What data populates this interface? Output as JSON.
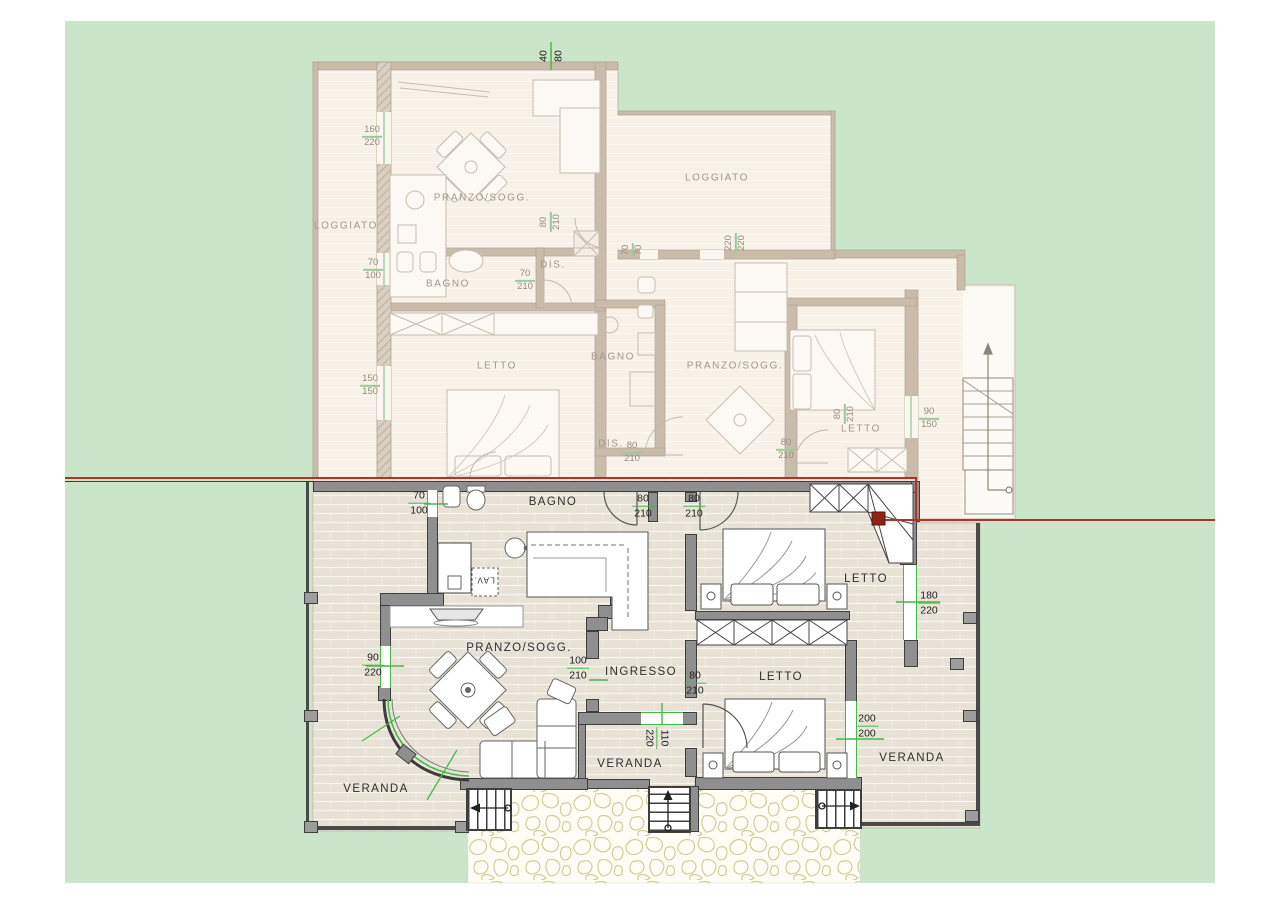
{
  "scene": {
    "background": "#ffffff",
    "lawn_color": "#cbe5ca",
    "section_line_color": "#b23228",
    "dimension_color": "#45b945",
    "lower_floor_color": "#e8e1d5",
    "upper_floor_color": "#f7f1e8",
    "wall_color": "#8f8f8f",
    "wall_outline": "#3e3e3e",
    "stone_edge_color": "#d0ca8e",
    "text_color": "#2e2e2e",
    "faded_text_color": "#a2988b"
  },
  "lower_plan": {
    "rooms": [
      {
        "t": "BAGNO",
        "x": 553,
        "y": 502
      },
      {
        "t": "PRANZO/SOGG.",
        "x": 519,
        "y": 648
      },
      {
        "t": "INGRESSO",
        "x": 641,
        "y": 672
      },
      {
        "t": "LETTO",
        "x": 866,
        "y": 579
      },
      {
        "t": "LETTO",
        "x": 781,
        "y": 677
      },
      {
        "t": "VERANDA",
        "x": 376,
        "y": 789
      },
      {
        "t": "VERANDA",
        "x": 630,
        "y": 764
      },
      {
        "t": "VERANDA",
        "x": 912,
        "y": 758
      },
      {
        "t": "LAV.",
        "x": 484,
        "y": 580,
        "r": 180,
        "s": 8
      }
    ],
    "dims": [
      {
        "t": "70/100",
        "x": 419,
        "y": 503
      },
      {
        "t": "80/210",
        "x": 643,
        "y": 506
      },
      {
        "t": "80/210",
        "x": 694,
        "y": 506
      },
      {
        "t": "90/220",
        "x": 373,
        "y": 665
      },
      {
        "t": "100/210",
        "x": 578,
        "y": 668
      },
      {
        "t": "80/210",
        "x": 695,
        "y": 683
      },
      {
        "t": "110/220",
        "x": 657,
        "y": 738,
        "r": 90
      },
      {
        "t": "180/220",
        "x": 929,
        "y": 603
      },
      {
        "t": "200/200",
        "x": 867,
        "y": 726
      },
      {
        "t": "40/80",
        "x": 551,
        "y": 56,
        "r": -90
      }
    ]
  },
  "upper_plan": {
    "rooms": [
      {
        "t": "LOGGIATO",
        "x": 346,
        "y": 226
      },
      {
        "t": "PRANZO/SOGG.",
        "x": 482,
        "y": 198
      },
      {
        "t": "BAGNO",
        "x": 448,
        "y": 284
      },
      {
        "t": "DIS.",
        "x": 553,
        "y": 265
      },
      {
        "t": "LETTO",
        "x": 497,
        "y": 366
      },
      {
        "t": "LOGGIATO",
        "x": 717,
        "y": 178
      },
      {
        "t": "BAGNO",
        "x": 613,
        "y": 357
      },
      {
        "t": "PRANZO/SOGG.",
        "x": 735,
        "y": 366
      },
      {
        "t": "LETTO",
        "x": 861,
        "y": 429
      },
      {
        "t": "DIS.",
        "x": 611,
        "y": 444
      }
    ],
    "dims": [
      {
        "t": "160/220",
        "x": 372,
        "y": 137
      },
      {
        "t": "70/100",
        "x": 373,
        "y": 270
      },
      {
        "t": "150/150",
        "x": 370,
        "y": 386
      },
      {
        "t": "70/210",
        "x": 525,
        "y": 281
      },
      {
        "t": "80/210",
        "x": 551,
        "y": 222,
        "r": -90
      },
      {
        "t": "70/70",
        "x": 633,
        "y": 250,
        "r": -90
      },
      {
        "t": "220/220",
        "x": 736,
        "y": 243,
        "r": -90
      },
      {
        "t": "80/210",
        "x": 632,
        "y": 453
      },
      {
        "t": "80/210",
        "x": 845,
        "y": 414,
        "r": -90
      },
      {
        "t": "90/150",
        "x": 929,
        "y": 419
      },
      {
        "t": "80/210",
        "x": 786,
        "y": 450
      }
    ]
  }
}
